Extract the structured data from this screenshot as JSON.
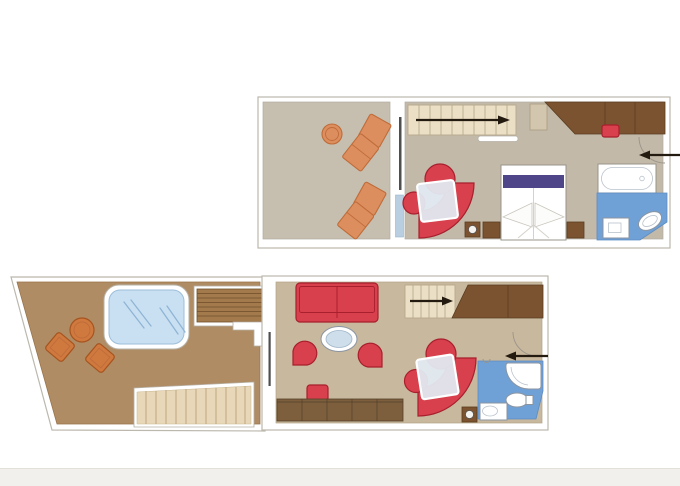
{
  "image": {
    "type": "cruise-suite-floor-plan",
    "background": "#ffffff",
    "text_visible": false
  },
  "colors": {
    "footer_band": "#f2f0ed",
    "wall_outline": "#bcb8ae",
    "upper_terrace_floor": "#c6bfb0",
    "upper_interior_floor": "#c2b9a8",
    "lower_interior_floor": "#c8b89d",
    "lower_terrace_floor": "#b08c64",
    "wood_dark": "#7b5330",
    "desk_wood": "#7d5f3d",
    "stair_beige": "#ebdfc6",
    "deck_beige": "#e8d7b8",
    "terrace_stair_wood": "#a37a4c",
    "orange_furniture": "#dd8e5e",
    "orange_border": "#bf6c3a",
    "red_furniture": "#d8404e",
    "red_border": "#a81f2d",
    "purple_bed_runner": "#4f4589",
    "whirlpool_blue": "#c9e0f2",
    "bathroom_blue": "#6fa0d6",
    "glass_blue": "#b9cfe1",
    "table_glass": "#e1e9f1",
    "arrow_black": "#231a10"
  },
  "upper_deck": {
    "areas": [
      "balcony-terrace",
      "bedroom-lounge",
      "bathroom",
      "staircase",
      "entry"
    ],
    "stair_arrow_direction": "right",
    "entry_arrow_direction": "left",
    "furniture": [
      "round-table",
      "sun-lounger",
      "sun-lounger",
      "sliding-glass-door",
      "staircase",
      "handrail",
      "dresser",
      "wardrobe",
      "stool",
      "entry-door",
      "curved-sofa",
      "armchair",
      "side-chair",
      "glass-table",
      "side-table",
      "double-bed",
      "nightstand",
      "nightstand",
      "bathtub",
      "toilet",
      "washbasin"
    ]
  },
  "lower_deck": {
    "areas": [
      "terrace",
      "living-room",
      "bathroom",
      "staircase",
      "entry"
    ],
    "stair_arrow_direction": "right",
    "entry_arrow_direction": "left",
    "furniture": [
      "whirlpool-bath",
      "round-table",
      "deck-chair",
      "deck-chair",
      "terrace-staircase",
      "railing",
      "deck-steps",
      "sliding-glass-door",
      "sofa",
      "oval-coffee-table",
      "tub-chair",
      "tub-chair",
      "stool",
      "desk-sideboard",
      "curved-sofa",
      "armchair",
      "side-chair",
      "glass-table",
      "side-table",
      "staircase",
      "wardrobe",
      "entry-door",
      "shower",
      "toilet",
      "washbasin"
    ]
  }
}
